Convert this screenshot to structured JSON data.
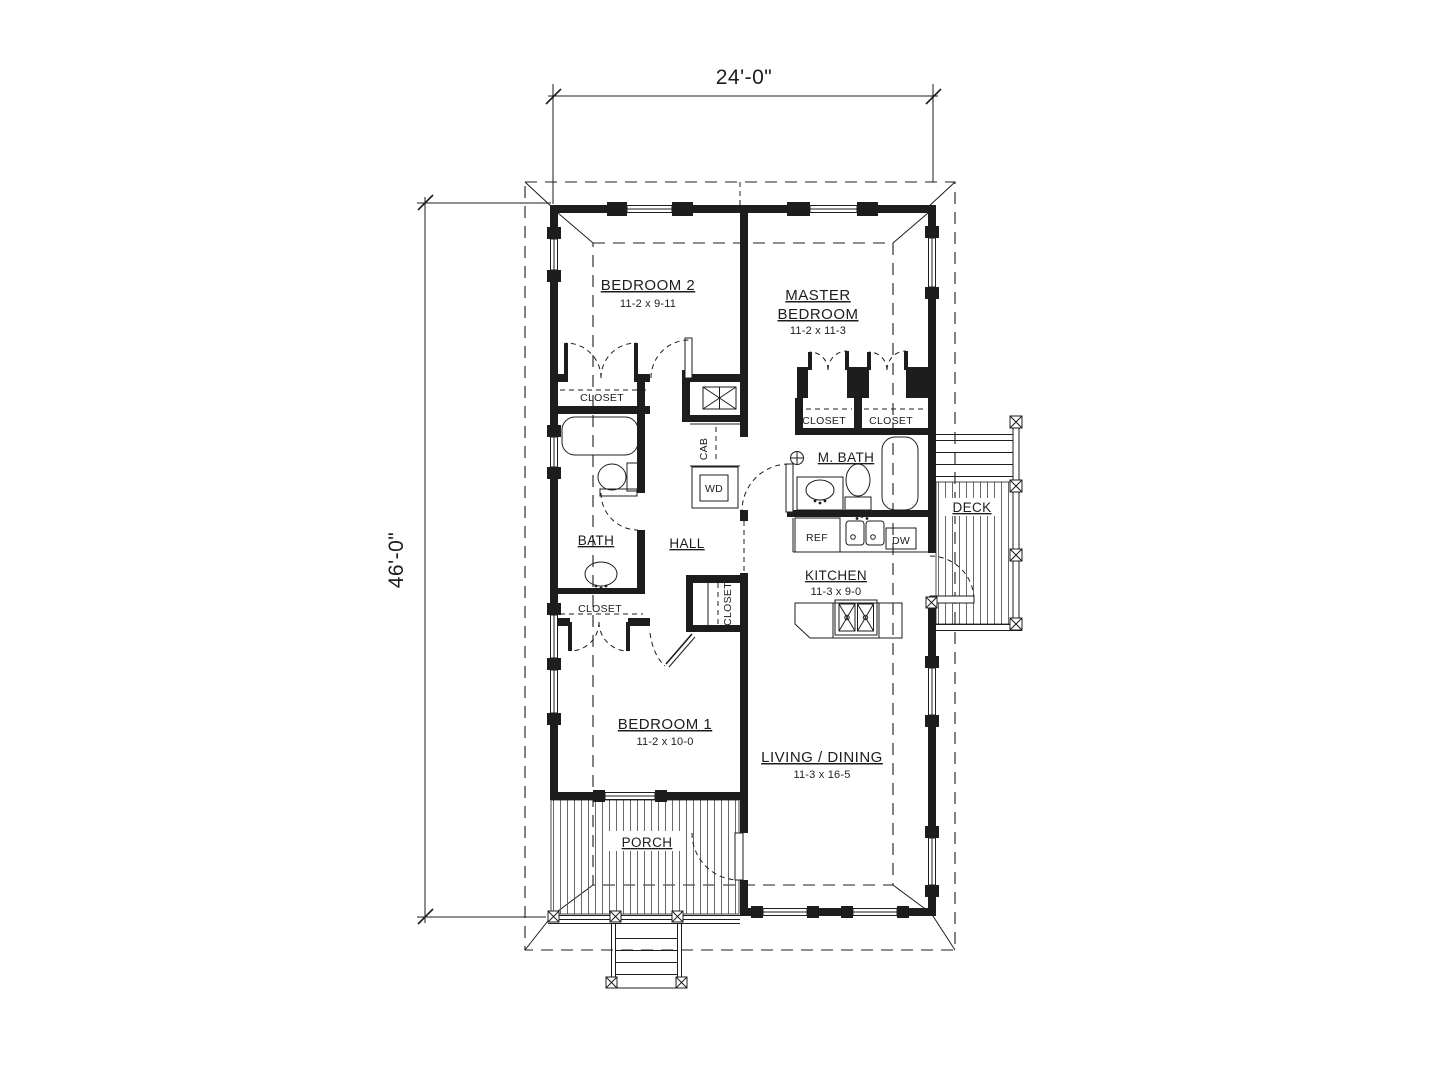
{
  "floor_plan": {
    "overall_width": "24'-0\"",
    "overall_depth": "46'-0\"",
    "rooms": {
      "bedroom2": {
        "name": "BEDROOM 2",
        "size": "11-2 x 9-11"
      },
      "master_bedroom": {
        "name_line1": "MASTER",
        "name_line2": "BEDROOM",
        "size": "11-2 x 11-3"
      },
      "bedroom1": {
        "name": "BEDROOM 1",
        "size": "11-2 x 10-0"
      },
      "living_dining": {
        "name": "LIVING / DINING",
        "size": "11-3 x 16-5"
      },
      "kitchen": {
        "name": "KITCHEN",
        "size": "11-3 x 9-0"
      },
      "bath": {
        "name": "BATH"
      },
      "master_bath": {
        "name": "M. BATH"
      },
      "hall": {
        "name": "HALL"
      },
      "porch": {
        "name": "PORCH"
      },
      "deck": {
        "name": "DECK"
      }
    },
    "fixtures": {
      "closet": "CLOSET",
      "refrigerator": "REF",
      "dishwasher": "DW",
      "washer_dryer": "WD",
      "cabinet": "CAB"
    },
    "colors": {
      "ink": "#1d1d1d",
      "paper": "#ffffff"
    }
  }
}
